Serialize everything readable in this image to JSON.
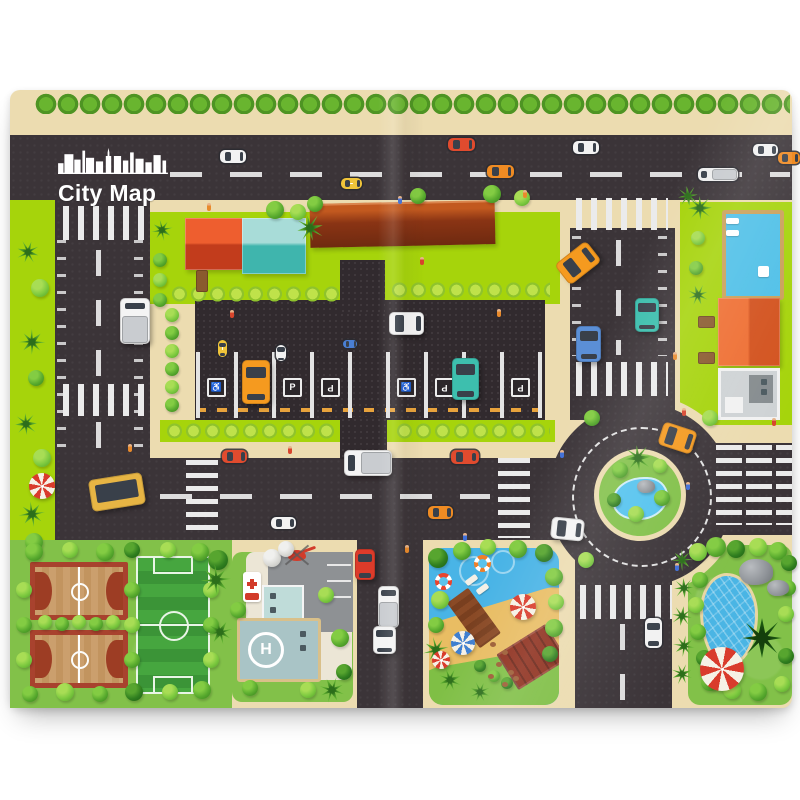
{
  "mat": {
    "title": "City Map",
    "logo_icon": "city-skyline-icon"
  },
  "palette": {
    "page_bg": "#ffffff",
    "sidewalk": "#ecdcb0",
    "road": "#3b3438",
    "lot": "#312a2e",
    "road_line": "#ebebeb",
    "lime": "#a6d40b",
    "grass": "#82c149",
    "hedge_light": "#bfe24a",
    "hedge_mid": "#8fc32c",
    "water": "#49b4e6",
    "pond": "#53c3ef",
    "sand": "#e9bd63",
    "red_roof": "#dc4829",
    "teal_roof": "#56c5bc",
    "long_building": "#8a3414",
    "orange_house": "#e8622f",
    "court_border": "#a8422e",
    "field_green_a": "#46a63f",
    "field_green_b": "#3b9437"
  },
  "signs": {
    "p_label": "P",
    "accessible_glyph": "♿",
    "helipad_label": "H",
    "hospital_sign_icon": "red-cross",
    "parking_y": 288,
    "parking": [
      {
        "x": 205,
        "kind": "accessible"
      },
      {
        "x": 281,
        "kind": "p"
      },
      {
        "x": 319,
        "kind": "p",
        "flip": true
      },
      {
        "x": 395,
        "kind": "accessible"
      },
      {
        "x": 433,
        "kind": "p",
        "flip": true
      },
      {
        "x": 509,
        "kind": "p",
        "flip": true
      }
    ]
  },
  "parking_lot": {
    "stall_lines": {
      "x0": 186,
      "pitch": 38,
      "count": 10,
      "y": 262,
      "h": 66
    }
  },
  "vehicles": [
    {
      "kind": "car",
      "style": "print",
      "color": "#f2f2f2",
      "x": 210,
      "y": 60,
      "w": 26,
      "h": 13,
      "rot": 0
    },
    {
      "kind": "car",
      "style": "print",
      "color": "#e04b2e",
      "x": 438,
      "y": 48,
      "w": 27,
      "h": 13,
      "rot": 0
    },
    {
      "kind": "car",
      "style": "print",
      "color": "#ef8b23",
      "x": 477,
      "y": 75,
      "w": 27,
      "h": 13,
      "rot": 0
    },
    {
      "kind": "car",
      "style": "print",
      "color": "#f2f2f2",
      "x": 563,
      "y": 51,
      "w": 26,
      "h": 13,
      "rot": 0
    },
    {
      "kind": "truck",
      "style": "print",
      "color": "#eeeeee",
      "x": 688,
      "y": 78,
      "w": 40,
      "h": 13,
      "rot": 0
    },
    {
      "kind": "car",
      "style": "print",
      "color": "#f2f2f2",
      "x": 743,
      "y": 54,
      "w": 25,
      "h": 12,
      "rot": 0
    },
    {
      "kind": "car",
      "style": "print",
      "color": "#ef8b23",
      "x": 768,
      "y": 62,
      "w": 22,
      "h": 12,
      "rot": 0
    },
    {
      "kind": "taxi",
      "style": "print",
      "color": "#f0c43a",
      "x": 331,
      "y": 88,
      "w": 21,
      "h": 11,
      "rot": 0
    },
    {
      "kind": "truckv",
      "style": "toy",
      "color": "#f4f4f4",
      "x": 110,
      "y": 208,
      "w": 30,
      "h": 46,
      "rot": 0
    },
    {
      "kind": "carv",
      "style": "toy",
      "color": "#f59a1f",
      "x": 232,
      "y": 270,
      "w": 28,
      "h": 44,
      "rot": 0
    },
    {
      "kind": "carv",
      "style": "toy",
      "color": "#3dbfae",
      "x": 442,
      "y": 268,
      "w": 27,
      "h": 42,
      "rot": 0
    },
    {
      "kind": "car",
      "style": "toy",
      "color": "#f4f4f4",
      "x": 379,
      "y": 222,
      "w": 35,
      "h": 23,
      "rot": 0
    },
    {
      "kind": "taxiv",
      "style": "print",
      "color": "#f0c43a",
      "x": 208,
      "y": 250,
      "w": 9,
      "h": 17,
      "rot": 0
    },
    {
      "kind": "carv",
      "style": "print",
      "color": "#f2f2f2",
      "x": 266,
      "y": 255,
      "w": 10,
      "h": 16,
      "rot": 0
    },
    {
      "kind": "car",
      "style": "print",
      "color": "#4a7fd4",
      "x": 333,
      "y": 250,
      "w": 14,
      "h": 8,
      "rot": 0
    },
    {
      "kind": "car",
      "style": "toy",
      "color": "#f59a1f",
      "x": 548,
      "y": 160,
      "w": 40,
      "h": 26,
      "rot": -38
    },
    {
      "kind": "carv",
      "style": "toy",
      "color": "#5b8fd6",
      "x": 566,
      "y": 236,
      "w": 25,
      "h": 36,
      "rot": 0
    },
    {
      "kind": "vanv",
      "style": "toy",
      "color": "#3dbfae",
      "x": 625,
      "y": 208,
      "w": 24,
      "h": 34,
      "rot": 0
    },
    {
      "kind": "car",
      "style": "toy",
      "color": "#f59a1f",
      "x": 650,
      "y": 336,
      "w": 35,
      "h": 24,
      "rot": 18
    },
    {
      "kind": "car",
      "style": "toy",
      "color": "#f4f4f4",
      "x": 541,
      "y": 428,
      "w": 33,
      "h": 22,
      "rot": 6
    },
    {
      "kind": "bus",
      "style": "toy",
      "color": "#e7b544",
      "x": 80,
      "y": 386,
      "w": 54,
      "h": 32,
      "rot": -9
    },
    {
      "kind": "car",
      "style": "print",
      "color": "#e04b2e",
      "x": 212,
      "y": 360,
      "w": 25,
      "h": 13,
      "rot": 0
    },
    {
      "kind": "car",
      "style": "print",
      "color": "#f2f2f2",
      "x": 261,
      "y": 427,
      "w": 25,
      "h": 12,
      "rot": 0
    },
    {
      "kind": "car",
      "style": "print",
      "color": "#ef8b23",
      "x": 418,
      "y": 416,
      "w": 25,
      "h": 13,
      "rot": 0
    },
    {
      "kind": "van",
      "style": "print",
      "color": "#e04b2e",
      "x": 441,
      "y": 360,
      "w": 28,
      "h": 14,
      "rot": 0
    },
    {
      "kind": "truck",
      "style": "toy",
      "color": "#f4f4f4",
      "x": 334,
      "y": 360,
      "w": 48,
      "h": 26,
      "rot": 0
    },
    {
      "kind": "carv",
      "style": "toy",
      "color": "#dd3b2a",
      "x": 345,
      "y": 459,
      "w": 20,
      "h": 31,
      "rot": 0
    },
    {
      "kind": "truckv",
      "style": "toy",
      "color": "#f4f4f4",
      "x": 368,
      "y": 496,
      "w": 21,
      "h": 42,
      "rot": 0
    },
    {
      "kind": "carv",
      "style": "toy",
      "color": "#f4f4f4",
      "x": 363,
      "y": 536,
      "w": 23,
      "h": 28,
      "rot": 0
    },
    {
      "kind": "carv",
      "style": "print",
      "color": "#f2f2f2",
      "x": 635,
      "y": 528,
      "w": 17,
      "h": 30,
      "rot": 0
    }
  ],
  "scenery": {
    "trees": [
      [
        265,
        120,
        9,
        "m"
      ],
      [
        288,
        122,
        8,
        "l"
      ],
      [
        305,
        114,
        8,
        "m"
      ],
      [
        408,
        106,
        8,
        "m"
      ],
      [
        482,
        104,
        9,
        "m"
      ],
      [
        512,
        108,
        8,
        "l"
      ],
      [
        162,
        225,
        7,
        "l"
      ],
      [
        162,
        243,
        7,
        "m"
      ],
      [
        162,
        261,
        7,
        "l"
      ],
      [
        162,
        279,
        7,
        "m"
      ],
      [
        162,
        297,
        7,
        "l"
      ],
      [
        162,
        315,
        7,
        "m"
      ],
      [
        150,
        170,
        7,
        "m"
      ],
      [
        150,
        190,
        7,
        "l"
      ],
      [
        150,
        210,
        7,
        "m"
      ],
      [
        30,
        198,
        9,
        "l"
      ],
      [
        26,
        288,
        8,
        "m"
      ],
      [
        32,
        368,
        9,
        "l"
      ],
      [
        24,
        452,
        9,
        "m"
      ],
      [
        688,
        148,
        7,
        "l"
      ],
      [
        686,
        178,
        7,
        "m"
      ],
      [
        610,
        380,
        8,
        "m"
      ],
      [
        650,
        376,
        7,
        "l"
      ],
      [
        604,
        410,
        7,
        "d"
      ],
      [
        652,
        408,
        8,
        "m"
      ],
      [
        626,
        424,
        8,
        "l"
      ],
      [
        582,
        328,
        8,
        "m"
      ],
      [
        700,
        328,
        8,
        "l"
      ],
      [
        576,
        470,
        8,
        "l"
      ],
      [
        24,
        462,
        9,
        "m"
      ],
      [
        60,
        460,
        8,
        "l"
      ],
      [
        95,
        462,
        9,
        "m"
      ],
      [
        122,
        460,
        8,
        "d"
      ],
      [
        158,
        460,
        8,
        "l"
      ],
      [
        190,
        462,
        9,
        "m"
      ],
      [
        208,
        470,
        10,
        "d"
      ],
      [
        20,
        604,
        8,
        "m"
      ],
      [
        55,
        602,
        9,
        "l"
      ],
      [
        90,
        604,
        8,
        "m"
      ],
      [
        124,
        602,
        9,
        "d"
      ],
      [
        160,
        602,
        8,
        "l"
      ],
      [
        192,
        600,
        9,
        "m"
      ],
      [
        14,
        500,
        8,
        "l"
      ],
      [
        14,
        535,
        8,
        "m"
      ],
      [
        14,
        570,
        8,
        "l"
      ],
      [
        122,
        500,
        8,
        "m"
      ],
      [
        122,
        535,
        8,
        "l"
      ],
      [
        122,
        570,
        8,
        "m"
      ],
      [
        201,
        500,
        8,
        "l"
      ],
      [
        201,
        535,
        8,
        "m"
      ],
      [
        201,
        570,
        8,
        "l"
      ],
      [
        35,
        532,
        7,
        "l"
      ],
      [
        52,
        534,
        7,
        "m"
      ],
      [
        69,
        532,
        7,
        "l"
      ],
      [
        86,
        534,
        7,
        "m"
      ],
      [
        103,
        532,
        7,
        "l"
      ],
      [
        228,
        520,
        8,
        "m"
      ],
      [
        316,
        505,
        8,
        "l"
      ],
      [
        330,
        548,
        9,
        "m"
      ],
      [
        334,
        582,
        8,
        "d"
      ],
      [
        240,
        598,
        8,
        "m"
      ],
      [
        298,
        600,
        8,
        "l"
      ],
      [
        262,
        468,
        9,
        "w"
      ],
      [
        276,
        459,
        8,
        "w"
      ],
      [
        428,
        468,
        10,
        "d"
      ],
      [
        452,
        461,
        9,
        "m"
      ],
      [
        478,
        457,
        8,
        "l"
      ],
      [
        508,
        459,
        9,
        "m"
      ],
      [
        534,
        463,
        9,
        "d"
      ],
      [
        544,
        487,
        9,
        "m"
      ],
      [
        546,
        512,
        8,
        "l"
      ],
      [
        544,
        538,
        9,
        "m"
      ],
      [
        540,
        564,
        8,
        "d"
      ],
      [
        430,
        510,
        9,
        "l"
      ],
      [
        426,
        535,
        8,
        "m"
      ],
      [
        470,
        576,
        6,
        "d"
      ],
      [
        484,
        586,
        6,
        "m"
      ],
      [
        497,
        593,
        6,
        "d"
      ],
      [
        688,
        462,
        9,
        "l"
      ],
      [
        706,
        457,
        10,
        "m"
      ],
      [
        726,
        459,
        9,
        "d"
      ],
      [
        748,
        457,
        9,
        "l"
      ],
      [
        768,
        461,
        9,
        "m"
      ],
      [
        779,
        473,
        8,
        "d"
      ],
      [
        778,
        498,
        8,
        "m"
      ],
      [
        776,
        524,
        8,
        "l"
      ],
      [
        690,
        490,
        8,
        "m"
      ],
      [
        686,
        515,
        8,
        "l"
      ],
      [
        688,
        542,
        8,
        "m"
      ],
      [
        694,
        568,
        8,
        "d"
      ],
      [
        700,
        592,
        9,
        "m"
      ],
      [
        722,
        600,
        9,
        "l"
      ],
      [
        748,
        602,
        9,
        "m"
      ],
      [
        772,
        594,
        8,
        "l"
      ],
      [
        776,
        566,
        8,
        "d"
      ]
    ],
    "palms": [
      [
        300,
        138,
        13
      ],
      [
        690,
        118,
        12
      ],
      [
        678,
        106,
        10
      ],
      [
        688,
        205,
        10
      ],
      [
        18,
        162,
        11
      ],
      [
        22,
        252,
        12
      ],
      [
        16,
        334,
        11
      ],
      [
        22,
        424,
        12
      ],
      [
        628,
        368,
        13
      ],
      [
        206,
        490,
        14
      ],
      [
        210,
        542,
        12
      ],
      [
        322,
        600,
        12
      ],
      [
        426,
        560,
        12
      ],
      [
        440,
        590,
        11
      ],
      [
        470,
        602,
        10
      ],
      [
        672,
        470,
        10
      ],
      [
        674,
        498,
        10
      ],
      [
        672,
        526,
        10
      ],
      [
        674,
        556,
        10
      ],
      [
        672,
        584,
        10
      ],
      [
        152,
        140,
        10
      ]
    ],
    "spiky": [
      [
        752,
        548,
        20
      ]
    ],
    "umbrellas": [
      [
        32,
        396,
        13,
        "#d93b2c"
      ],
      [
        513,
        517,
        13,
        "#d93b2c"
      ],
      [
        453,
        553,
        12,
        "#3f7fd0"
      ],
      [
        431,
        570,
        9,
        "#d93b2c"
      ],
      [
        712,
        579,
        22,
        "#d93b2c"
      ]
    ],
    "rings": [
      [
        472,
        473,
        "#f07f28"
      ],
      [
        433,
        491,
        "#e8452f"
      ]
    ],
    "rocks": [
      [
        746,
        482,
        34,
        26
      ],
      [
        768,
        498,
        22,
        16
      ],
      [
        636,
        396,
        18,
        13
      ]
    ],
    "stones": [
      [
        480,
        552
      ],
      [
        492,
        560
      ],
      [
        486,
        572
      ],
      [
        498,
        580
      ],
      [
        478,
        584
      ],
      [
        492,
        592
      ],
      [
        503,
        586
      ]
    ],
    "people": [
      [
        197,
        113,
        "#e98a2b"
      ],
      [
        388,
        106,
        "#3f6fd8"
      ],
      [
        410,
        167,
        "#d8452c"
      ],
      [
        513,
        100,
        "#e98a2b"
      ],
      [
        550,
        360,
        "#3f6fd8"
      ],
      [
        118,
        354,
        "#e98a2b"
      ],
      [
        278,
        356,
        "#d8452c"
      ],
      [
        453,
        443,
        "#3f6fd8"
      ],
      [
        663,
        262,
        "#e98a2b"
      ],
      [
        672,
        318,
        "#d8452c"
      ],
      [
        676,
        392,
        "#3f6fd8"
      ],
      [
        395,
        455,
        "#e98a2b"
      ],
      [
        665,
        473,
        "#3f6fd8"
      ],
      [
        220,
        220,
        "#d8452c"
      ],
      [
        487,
        219,
        "#e98a2b"
      ],
      [
        762,
        328,
        "#d8452c"
      ]
    ],
    "benches": [
      [
        688,
        226,
        15,
        10
      ],
      [
        688,
        262,
        15,
        10
      ],
      [
        186,
        180,
        10,
        20
      ]
    ],
    "deck_items": [
      [
        716,
        128,
        13,
        6
      ],
      [
        716,
        140,
        13,
        6
      ],
      [
        748,
        176,
        11,
        11
      ]
    ],
    "loungers": [
      [
        455,
        487,
        -36
      ],
      [
        466,
        496,
        -36
      ]
    ]
  }
}
